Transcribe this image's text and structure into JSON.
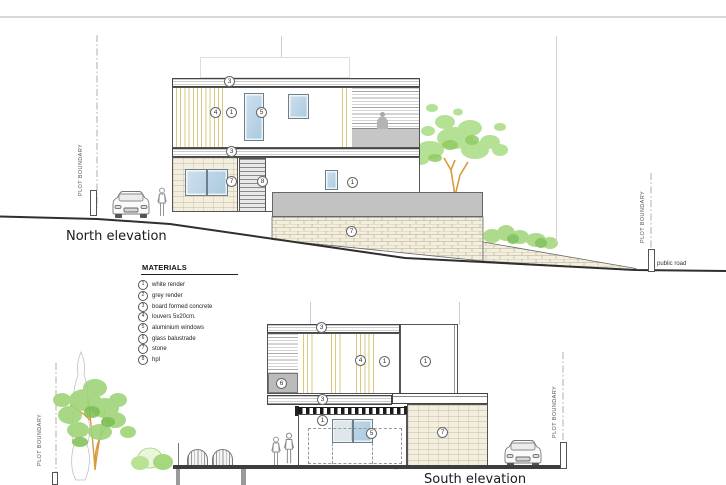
{
  "meta": {
    "north_label": "North elevation",
    "south_label": "South elevation",
    "public_road": "public road",
    "plot_boundary": "PLOT BOUNDARY"
  },
  "materials": {
    "title": "MATERIALS",
    "items": [
      {
        "num": "1",
        "label": "white render"
      },
      {
        "num": "2",
        "label": "grey render"
      },
      {
        "num": "3",
        "label": "board formed concrete"
      },
      {
        "num": "4",
        "label": "louvers 5x20cm."
      },
      {
        "num": "5",
        "label": "aluminium windows"
      },
      {
        "num": "6",
        "label": "glass balustrade"
      },
      {
        "num": "7",
        "label": "stone"
      },
      {
        "num": "8",
        "label": "hpl"
      }
    ]
  },
  "north": {
    "callouts": [
      {
        "n": "3"
      },
      {
        "n": "4"
      },
      {
        "n": "1"
      },
      {
        "n": "5"
      },
      {
        "n": "3"
      },
      {
        "n": "7"
      },
      {
        "n": "8"
      },
      {
        "n": "1"
      },
      {
        "n": "7"
      }
    ]
  },
  "south": {
    "callouts": [
      {
        "n": "3"
      },
      {
        "n": "4"
      },
      {
        "n": "1"
      },
      {
        "n": "1"
      },
      {
        "n": "6"
      },
      {
        "n": "3"
      },
      {
        "n": "1"
      },
      {
        "n": "5"
      },
      {
        "n": "7"
      }
    ]
  },
  "colors": {
    "stone_fill": "#f3eede",
    "stone_joint": "#b3aa8f",
    "parapet_grey": "#c2c2c2",
    "window_blue": "#aecbe0",
    "louver_yellow": "#d9c87e",
    "foliage_green": "#9fd47a",
    "trunk_orange": "#d79a3d",
    "drawing_line": "#444444"
  }
}
